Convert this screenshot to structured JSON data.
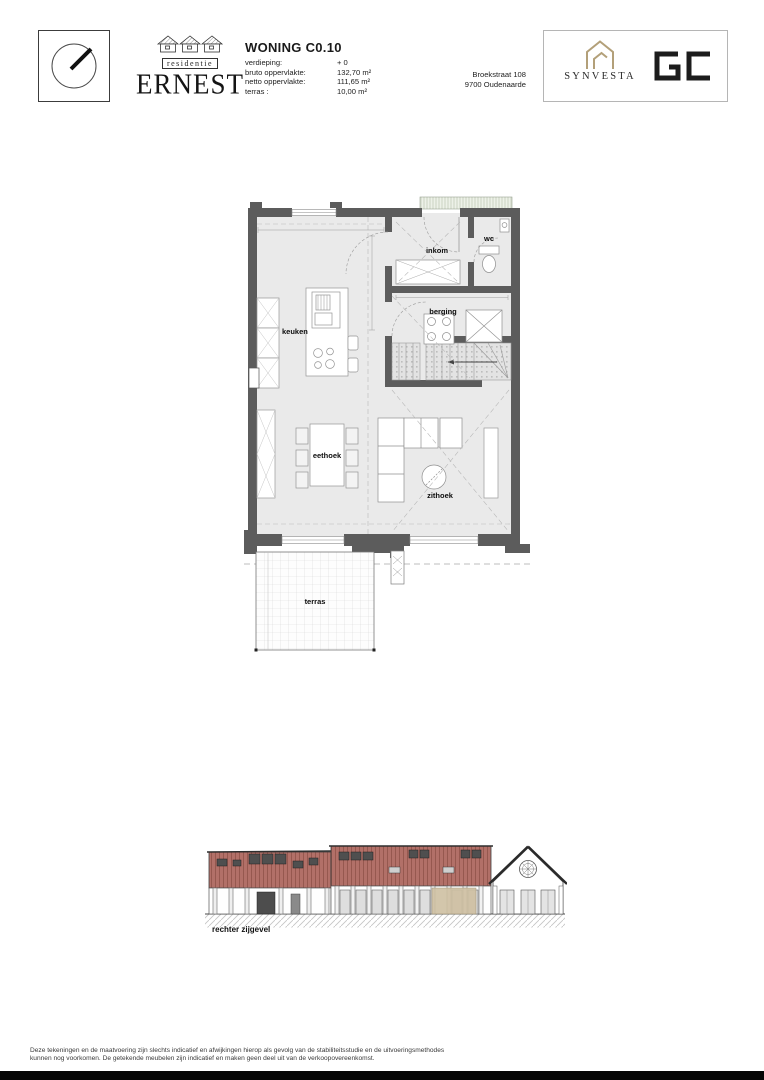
{
  "header": {
    "logo": {
      "band": "residentie",
      "name": "ERNEST"
    },
    "unit": {
      "title": "WONING C0.10",
      "specs": [
        {
          "label": "verdieping:",
          "value": "+ 0"
        },
        {
          "label": "bruto oppervlakte:",
          "value": "132,70 m²"
        },
        {
          "label": "netto oppervlakte:",
          "value": "111,65 m²"
        },
        {
          "label": "terras :",
          "value": "10,00 m²"
        }
      ]
    },
    "address": {
      "line1": "Broekstraat 108",
      "line2": "9700 Oudenaarde"
    },
    "brands": {
      "synvesta": "SYNVESTA",
      "gc": "GC"
    }
  },
  "icons": {
    "compass": "north-direction-dial",
    "ernest_houses": "three-house-roofs",
    "synvesta_house": "house-outline"
  },
  "plan": {
    "labels": {
      "keuken": "keuken",
      "inkom": "inkom",
      "wc": "wc",
      "berging": "berging",
      "eethoek": "eethoek",
      "zithoek": "zithoek",
      "terras": "terras"
    }
  },
  "elevation": {
    "caption": "rechter zijgevel"
  },
  "footer": {
    "line1": "Deze tekeningen en de maatvoering zijn slechts indicatief en afwijkingen hierop als gevolg van de stabiliteitsstudie en de uitvoeringsmethodes",
    "line2": "kunnen nog voorkomen. De getekende meubelen zijn indicatief en maken geen deel uit van de verkoopovereenkomst."
  },
  "colors": {
    "wall": "#5c5c5c",
    "floor": "#eaeaea",
    "facade_red": "#b27068",
    "highlight_tan": "#cfc0a2",
    "brand_gold": "#b3a079"
  }
}
